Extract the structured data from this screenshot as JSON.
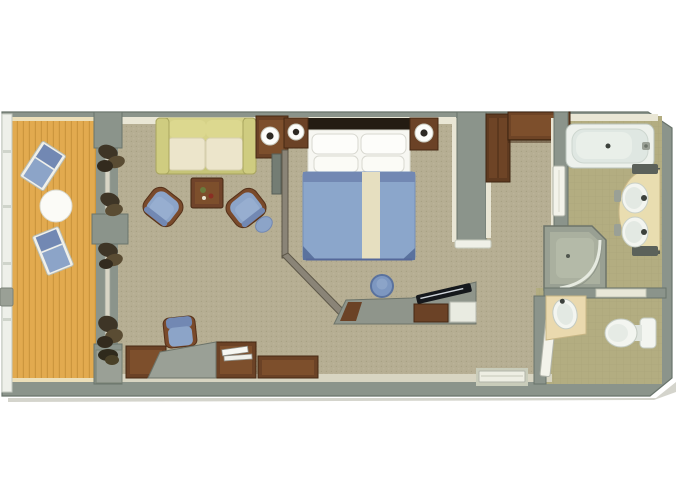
{
  "meta": {
    "title": "cruise-ship-suite-floor-plan",
    "width": 680,
    "height": 486,
    "view": "top-down 3D rendered floor plan, no visible text"
  },
  "palette": {
    "background": "#ffffff",
    "wall": "#8b948b",
    "wallEdge": "#69746b",
    "wallCream": "#e9e6d5",
    "carpet": "#b6ae93",
    "carpetDot": "#a49c80",
    "deckWood": "#e2aa4f",
    "deckWoodLine": "#c08a35",
    "bathFloor": "#b3ad81",
    "bathFloorLine": "#a39d74",
    "upholsteryBlue": "#8ca4c8",
    "upholsteryBlueDark": "#7288b3",
    "duvetNavy": "#5a729e",
    "woodBrown": "#6b4226",
    "woodBrownDark": "#452813",
    "sofaOlive": "#c9c77a",
    "sofaCushionCream": "#ece5cb",
    "bedRunnerCream": "#e6dfc0",
    "fixtureWhite": "#f3f5f0",
    "fixtureShade": "#e0e7e1",
    "furnitureGray": "#939a8f",
    "counterCream": "#e9ddb0",
    "curtainDark": "#3e3526",
    "tvScreenDark": "#15181c"
  },
  "floorplan": {
    "rooms": [
      {
        "id": "balcony",
        "label": "Balcony",
        "furniture": [
          "lounge-chair",
          "lounge-chair",
          "round-table",
          "railing",
          "glass-doors-with-curtains",
          "planter"
        ]
      },
      {
        "id": "living-room",
        "label": "Living Room",
        "furniture": [
          "sofa",
          "side-table-with-lamp",
          "coffee-table",
          "armchair",
          "armchair-with-ottoman",
          "desk",
          "desk-chair",
          "storage-cabinets",
          "wall-panel"
        ]
      },
      {
        "id": "bedroom",
        "label": "Bedroom",
        "furniture": [
          "double-bed",
          "nightstand-with-lamp",
          "nightstand-with-lamp",
          "vanity-stool",
          "tv-console",
          "minibar-cabinet"
        ]
      },
      {
        "id": "entry-corridor",
        "label": "Entry Corridor",
        "furniture": [
          "wardrobe",
          "entry-door",
          "bathroom-door"
        ]
      },
      {
        "id": "bathroom",
        "label": "Bathroom",
        "furniture": [
          "bathtub",
          "double-sink-vanity",
          "corner-shower"
        ]
      },
      {
        "id": "water-closet",
        "label": "Water Closet",
        "furniture": [
          "washbasin",
          "toilet",
          "wc-door"
        ]
      }
    ]
  }
}
